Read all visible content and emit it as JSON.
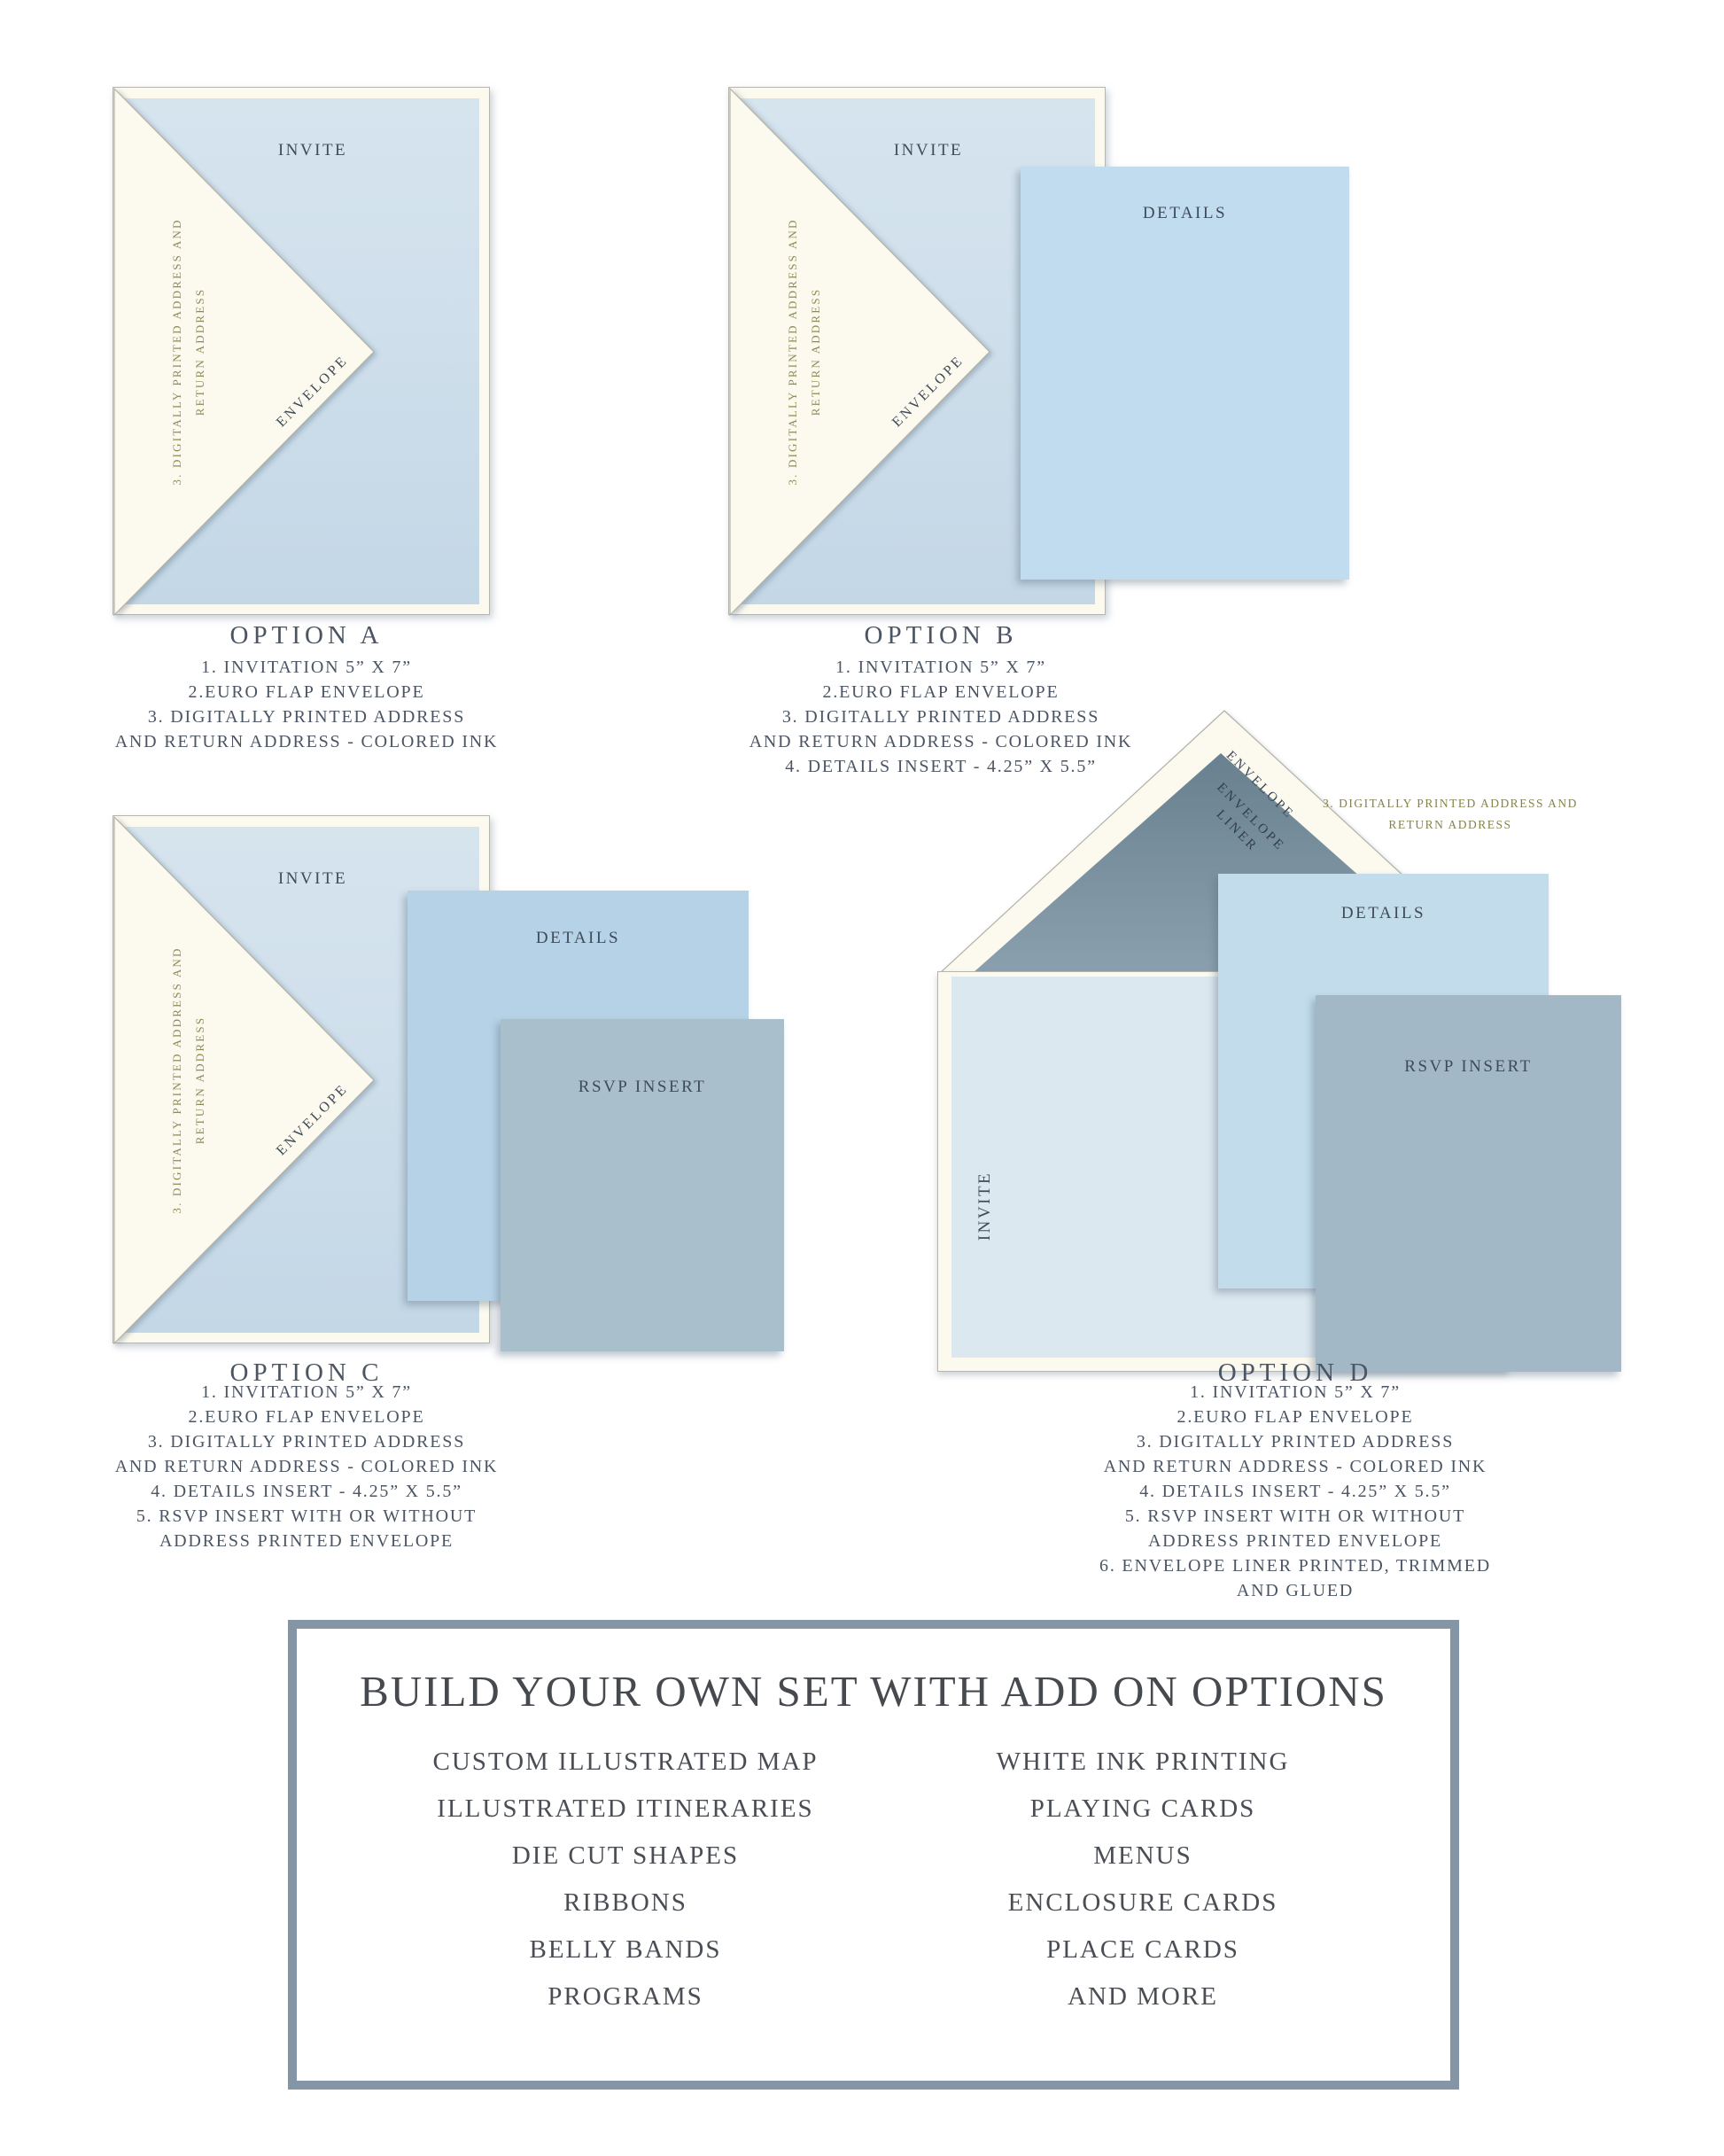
{
  "palette": {
    "cream": "#fcfaef",
    "invite_blue": "#cfdfeb",
    "invite_pale": "#dce8f0",
    "details_blue_b": "#c0dcee",
    "details_blue_c": "#b6d2e6",
    "details_blue_d": "#c2dcec",
    "rsvp_blue_c": "#a9bfcc",
    "rsvp_blue_d": "#a2b8c7",
    "liner_dark": "#68808f",
    "liner_light": "#8ba0ae",
    "text_navy": "#47525f",
    "text_olive": "#8d8b55",
    "box_border": "#8496a6"
  },
  "options": [
    {
      "id": "A",
      "caption": "OPTION A",
      "invite_label": "INVITE",
      "envelope_label": "ENVELOPE",
      "flap_note": [
        "3. DIGITALLY PRINTED ADDRESS AND",
        "RETURN ADDRESS"
      ],
      "list": [
        "1. INVITATION 5” X 7”",
        "2.EURO FLAP ENVELOPE",
        "3. DIGITALLY PRINTED ADDRESS",
        "AND RETURN ADDRESS - COLORED INK"
      ]
    },
    {
      "id": "B",
      "caption": "OPTION B",
      "invite_label": "INVITE",
      "envelope_label": "ENVELOPE",
      "details_label": "DETAILS",
      "flap_note": [
        "3. DIGITALLY PRINTED ADDRESS AND",
        "RETURN ADDRESS"
      ],
      "list": [
        "1. INVITATION 5” X 7”",
        "2.EURO FLAP ENVELOPE",
        "3. DIGITALLY PRINTED ADDRESS",
        "AND RETURN ADDRESS - COLORED INK",
        "4. DETAILS INSERT - 4.25” X 5.5”"
      ]
    },
    {
      "id": "C",
      "caption": "OPTION C",
      "invite_label": "INVITE",
      "envelope_label": "ENVELOPE",
      "details_label": "DETAILS",
      "rsvp_label": "RSVP INSERT",
      "flap_note": [
        "3. DIGITALLY PRINTED ADDRESS AND",
        "RETURN ADDRESS"
      ],
      "list": [
        "1. INVITATION 5” X 7”",
        "2.EURO FLAP ENVELOPE",
        "3. DIGITALLY PRINTED ADDRESS",
        "AND RETURN ADDRESS - COLORED INK",
        "4. DETAILS INSERT - 4.25” X 5.5”",
        "5. RSVP INSERT WITH OR WITHOUT",
        "ADDRESS PRINTED ENVELOPE"
      ]
    },
    {
      "id": "D",
      "caption": "OPTION D",
      "invite_label": "INVITE",
      "envelope_label": "ENVELOPE",
      "liner_label": [
        "ENVELOPE",
        "LINER"
      ],
      "details_label": "DETAILS",
      "rsvp_label": "RSVP INSERT",
      "address_note": [
        "3. DIGITALLY PRINTED ADDRESS AND",
        "RETURN ADDRESS"
      ],
      "list": [
        "1. INVITATION 5” X 7”",
        "2.EURO FLAP ENVELOPE",
        "3. DIGITALLY PRINTED ADDRESS",
        "AND RETURN ADDRESS - COLORED INK",
        "4. DETAILS INSERT - 4.25” X 5.5”",
        "5. RSVP INSERT WITH OR WITHOUT",
        "ADDRESS PRINTED ENVELOPE",
        "6. ENVELOPE LINER PRINTED, TRIMMED",
        "AND GLUED"
      ]
    }
  ],
  "addon_box": {
    "title": "BUILD YOUR OWN SET WITH ADD ON OPTIONS",
    "left_items": [
      "CUSTOM ILLUSTRATED MAP",
      "ILLUSTRATED ITINERARIES",
      "DIE CUT SHAPES",
      "RIBBONS",
      "BELLY BANDS",
      "PROGRAMS"
    ],
    "right_items": [
      "WHITE INK PRINTING",
      "PLAYING CARDS",
      "MENUS",
      "ENCLOSURE CARDS",
      "PLACE CARDS",
      "AND MORE"
    ]
  }
}
